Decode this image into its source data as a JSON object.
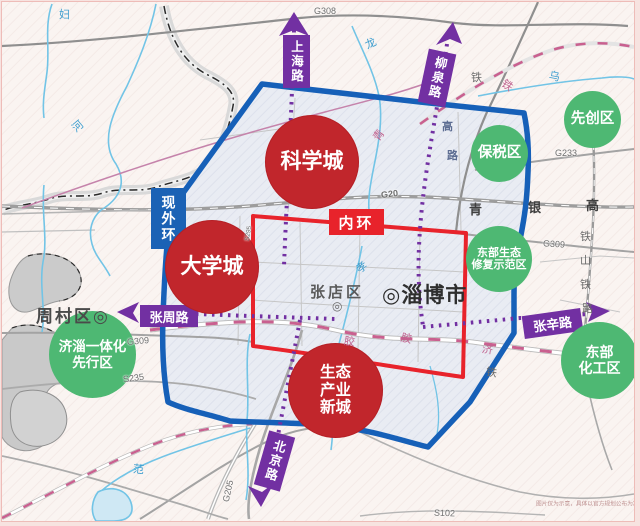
{
  "colors": {
    "red_zone": "#c1262c",
    "green_zone": "#4eb873",
    "purple_badge": "#7230a2",
    "blue_ring": "#1660b8",
    "red_ring": "#e8232b",
    "blue_badge": "#1b62b5"
  },
  "zones_red": [
    {
      "lines": [
        "科学城"
      ]
    },
    {
      "lines": [
        "大学城"
      ]
    },
    {
      "lines": [
        "生态",
        "产业",
        "新城"
      ]
    }
  ],
  "zones_green": [
    {
      "lines": [
        "先创区"
      ]
    },
    {
      "lines": [
        "保税区"
      ]
    },
    {
      "lines": [
        "东部生态",
        "修复示范区"
      ]
    },
    {
      "lines": [
        "济淄一体化",
        "先行区"
      ]
    },
    {
      "lines": [
        "东部",
        "化工区"
      ]
    }
  ],
  "badges": {
    "shanghai_road": "上海路",
    "liuquan_road": "柳泉路",
    "xian_outer_ring": "现外环",
    "inner_ring": "内环",
    "zhangzhou_road": "张周路",
    "zhangxin_road": "张辛路",
    "beijing_road": "北京路"
  },
  "places": {
    "zhoucun": "周村区◎",
    "zhangdian": "张店区",
    "zhangdian_marker": "◎",
    "zibo": "◎淄博市"
  },
  "shields": {
    "g308": "G308",
    "g233": "G233",
    "g20": "G20",
    "g309_e": "G309",
    "g309_w": "G309",
    "s235": "S235",
    "g205": "G205",
    "s102": "S102",
    "s295": "S295"
  },
  "chars": {
    "fu": "妇",
    "he": "河",
    "long": "龙",
    "wu": "乌",
    "xiao": "孝",
    "fan": "范",
    "tie_gray": "铁",
    "tie_pink": "铁",
    "qing_pink": "青",
    "gao_v": "高",
    "lu_v": "路",
    "jiao1": "胶",
    "jiao2": "胶",
    "ji": "济",
    "tie_mid": "铁",
    "qing": "青",
    "yin": "银",
    "gao": "高",
    "tie_shan": [
      "铁",
      "山",
      "铁",
      "路"
    ]
  },
  "disclaimer": "图片仅为示意，具体以官方规划公布为准。"
}
